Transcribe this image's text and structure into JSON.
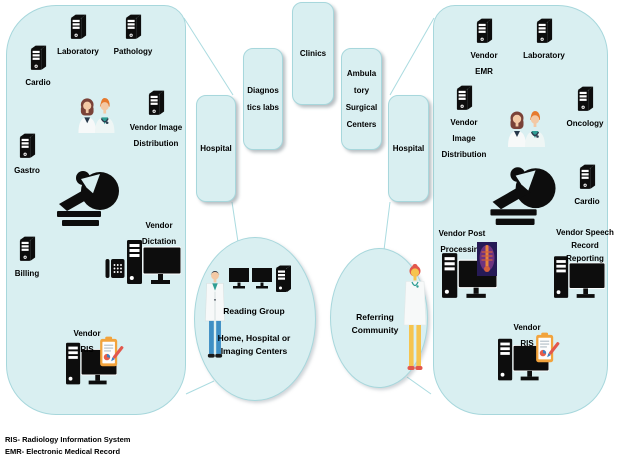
{
  "colors": {
    "canvas_bg": "#ffffff",
    "group_fill": "#d9eff1",
    "group_border": "#a7d7dc",
    "icon_black": "#0d0d0d",
    "clipboard_orange": "#f2a33c",
    "connector": "#aadbe0"
  },
  "left_group": {
    "nodes": [
      {
        "label": "Cardio",
        "icon": "server-icon"
      },
      {
        "label": "Laboratory",
        "icon": "server-icon"
      },
      {
        "label": "Pathology",
        "icon": "server-icon"
      },
      {
        "label": "Vendor Image\nDistribution",
        "icon": "server-icon"
      },
      {
        "label": "Gastro",
        "icon": "server-icon"
      },
      {
        "label": "Billing",
        "icon": "server-icon"
      },
      {
        "label": "Vendor\nDictation",
        "icon": "phone-and-workstation-icon"
      },
      {
        "label": "Vendor\nRIS",
        "icon": "workstation-with-clipboard-icon"
      }
    ],
    "decorations": [
      "doctors-pair-icon",
      "mri-scanner-icon"
    ]
  },
  "right_group": {
    "nodes": [
      {
        "label": "Vendor\nEMR",
        "icon": "server-icon"
      },
      {
        "label": "Laboratory",
        "icon": "server-icon"
      },
      {
        "label": "Vendor\nImage\nDistribution",
        "icon": "server-icon"
      },
      {
        "label": "Oncology",
        "icon": "server-icon"
      },
      {
        "label": "Cardio",
        "icon": "server-icon"
      },
      {
        "label": "Vendor Post\nProcessing",
        "icon": "workstation-with-scan-icon"
      },
      {
        "label": "Vendor Speech\nRecord\nReporting",
        "icon": "workstation-icon"
      },
      {
        "label": "Vendor\nRIS",
        "icon": "workstation-with-clipboard-icon"
      }
    ],
    "decorations": [
      "doctors-pair-icon",
      "mri-scanner-icon"
    ]
  },
  "facilities": [
    {
      "label": "Hospital"
    },
    {
      "label": "Diagnos\ntics labs"
    },
    {
      "label": "Clinics"
    },
    {
      "label": "Ambula\ntory\nSurgical\nCenters"
    },
    {
      "label": "Hospital"
    }
  ],
  "reading_group": {
    "title": "Reading Group",
    "subtitle": "Home, Hospital or\nImaging Centers"
  },
  "referring_community": {
    "title": "Referring\nCommunity"
  },
  "legend": {
    "line1": "RIS- Radiology Information System",
    "line2": "EMR- Electronic Medical Record"
  }
}
